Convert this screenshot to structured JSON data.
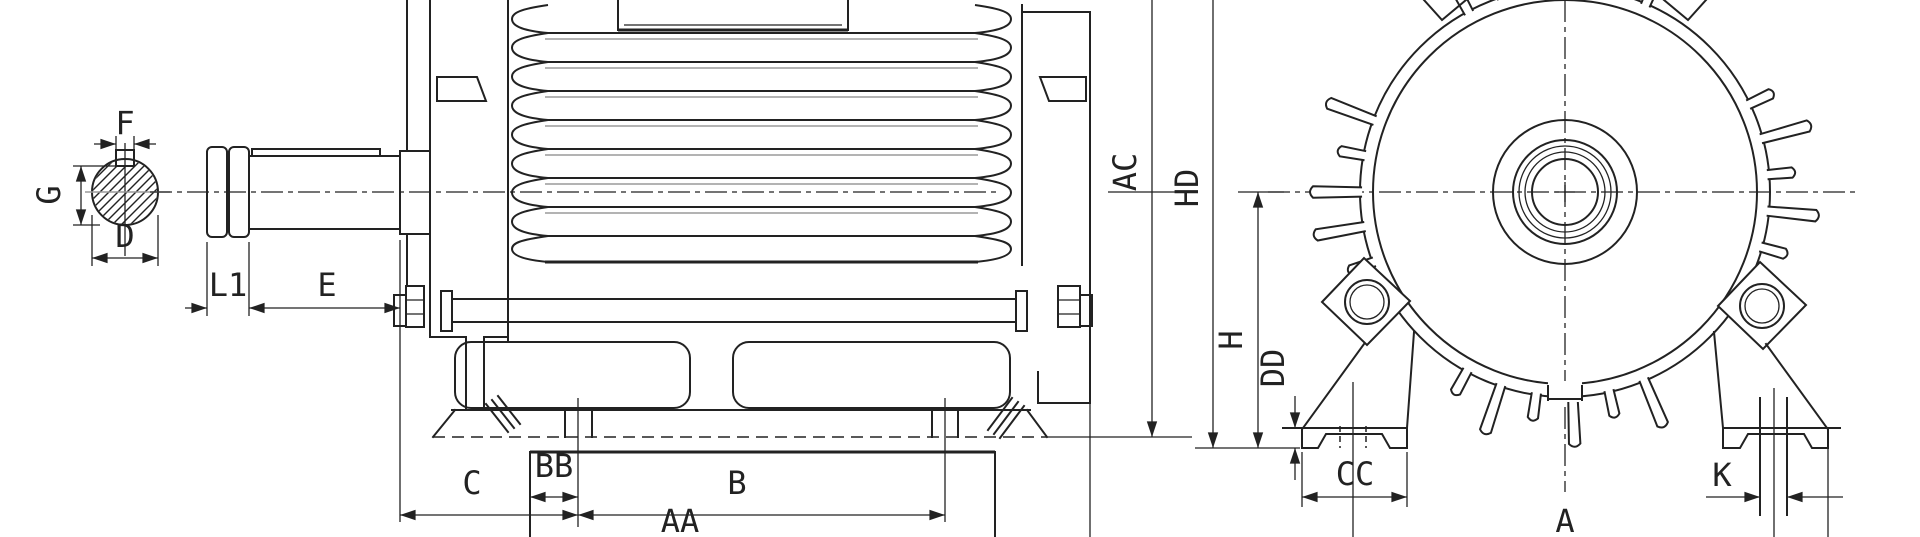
{
  "drawing": {
    "kind": "motor-outline-dimension-drawing",
    "background": "#ffffff",
    "line_color": "#222222",
    "accent_gray": "#9a9a9a"
  },
  "dims": {
    "f": "F",
    "g": "G",
    "d": "D",
    "l1": "L1",
    "e": "E",
    "c": "C",
    "bb": "BB",
    "b": "B",
    "aa": "AA",
    "ac": "AC",
    "hd": "HD",
    "h": "H",
    "dd": "DD",
    "cc": "CC",
    "a": "A",
    "k": "K"
  }
}
